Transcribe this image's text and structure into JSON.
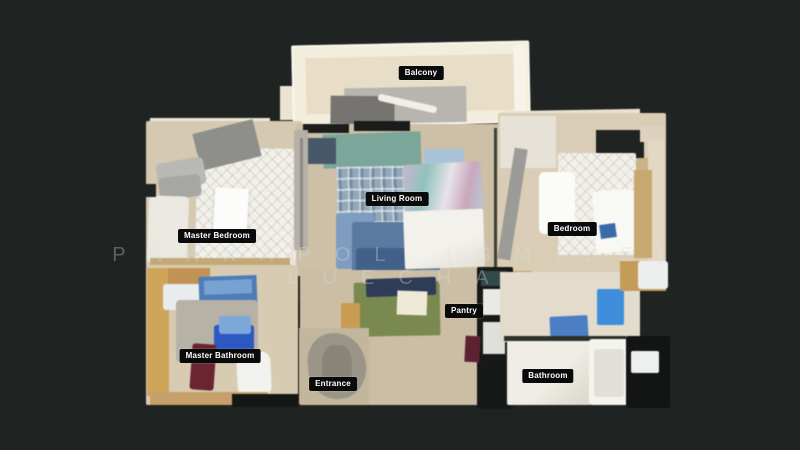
{
  "app": {
    "background_color": "#1f2322",
    "view": "3D dollhouse floor plan"
  },
  "watermark": {
    "line1": "PAKKAPOL (SMILE)",
    "line2": "LUECHA",
    "color": "rgba(216,224,224,0.33)"
  },
  "rooms": {
    "balcony": "Balcony",
    "living_room": "Living Room",
    "master_bedroom": "Master Bedroom",
    "bedroom": "Bedroom",
    "pantry": "Pantry",
    "master_bathroom": "Master Bathroom",
    "bathroom": "Bathroom",
    "entrance": "Entrance"
  },
  "room_label_style": {
    "background": "#0a0a0a",
    "text_color": "#ffffff"
  },
  "floor_palette": {
    "main_floor": "#d2c5ac",
    "balcony_cream": "#f3eddd",
    "accent_blue": "#4a7ec6"
  }
}
